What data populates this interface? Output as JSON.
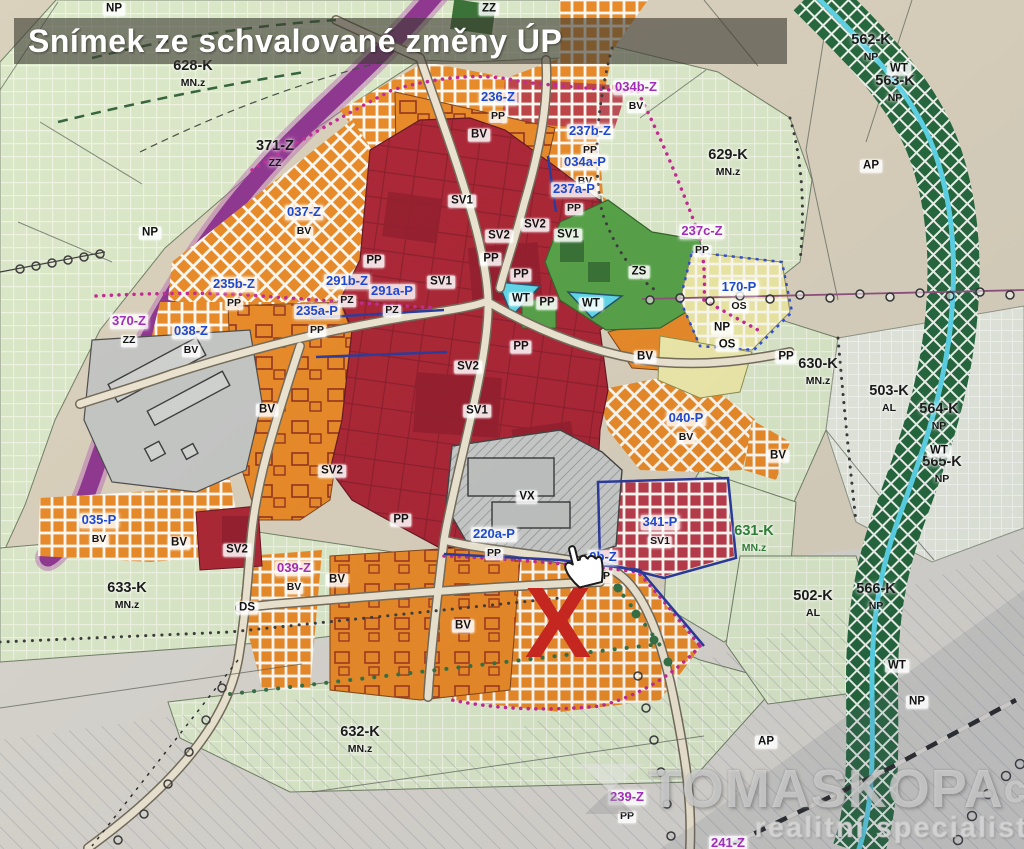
{
  "banner": {
    "text": "Snímek ze schvalované změny ÚP"
  },
  "marker": {
    "text": "X",
    "color": "#c3271f"
  },
  "icons": {
    "cursor": "hand-pointer-icon",
    "watermark_logo": "tomaskopa-logo-icon"
  },
  "watermark": {
    "brand": "TOMASKOPA",
    "suffix": "cz",
    "tagline": "realitní specialista"
  },
  "colors": {
    "banner_bg": "#3e3c32",
    "sv_red": "#a81c2c",
    "bv_orange": "#e8851e",
    "zs_green": "#4f9e3f",
    "os_yellow": "#ece79f",
    "water_cyan": "#55d2e6",
    "corridor_purple": "#8a2d8c",
    "marker_red": "#c3271f"
  },
  "map": {
    "labels": [
      {
        "t": "628-K",
        "s": "MN.z",
        "x": 193,
        "y": 74,
        "v": "k"
      },
      {
        "t": "629-K",
        "s": "MN.z",
        "x": 728,
        "y": 163,
        "v": "k"
      },
      {
        "t": "630-K",
        "s": "MN.z",
        "x": 818,
        "y": 372,
        "v": "k"
      },
      {
        "t": "503-K",
        "s": "AL",
        "x": 889,
        "y": 399,
        "v": "k"
      },
      {
        "t": "564-K",
        "s": "NP",
        "x": 939,
        "y": 417,
        "v": "k"
      },
      {
        "t": "565-K",
        "s": "NP",
        "x": 942,
        "y": 470,
        "v": "k"
      },
      {
        "t": "562-K",
        "s": "NP",
        "x": 871,
        "y": 48,
        "v": "k"
      },
      {
        "t": "563-K",
        "s": "NP",
        "x": 895,
        "y": 89,
        "v": "k"
      },
      {
        "t": "566-K",
        "s": "NP",
        "x": 876,
        "y": 597,
        "v": "k"
      },
      {
        "t": "502-K",
        "s": "AL",
        "x": 813,
        "y": 604,
        "v": "k"
      },
      {
        "t": "632-K",
        "s": "MN.z",
        "x": 360,
        "y": 740,
        "v": "k"
      },
      {
        "t": "633-K",
        "s": "MN.z",
        "x": 127,
        "y": 596,
        "v": "k"
      },
      {
        "t": "631-K",
        "s": "MN.z",
        "x": 754,
        "y": 539,
        "v": "kg"
      },
      {
        "t": "371-Z",
        "s": "ZZ",
        "x": 275,
        "y": 154,
        "v": "k"
      },
      {
        "t": "236-Z",
        "s": "PP",
        "x": 498,
        "y": 106,
        "v": "b"
      },
      {
        "t": "237b-Z",
        "s": "PP",
        "x": 590,
        "y": 140,
        "v": "b"
      },
      {
        "t": "034a-P",
        "s": "BV",
        "x": 585,
        "y": 171,
        "v": "b"
      },
      {
        "t": "237a-P",
        "s": "PP",
        "x": 574,
        "y": 198,
        "v": "b"
      },
      {
        "t": "170-P",
        "s": "OS",
        "x": 739,
        "y": 296,
        "v": "b"
      },
      {
        "t": "037-Z",
        "s": "BV",
        "x": 304,
        "y": 221,
        "v": "b"
      },
      {
        "t": "235b-Z",
        "s": "PP",
        "x": 234,
        "y": 293,
        "v": "b"
      },
      {
        "t": "291b-Z",
        "s": "PZ",
        "x": 347,
        "y": 290,
        "v": "b"
      },
      {
        "t": "291a-P",
        "s": "PZ",
        "x": 392,
        "y": 300,
        "v": "b"
      },
      {
        "t": "235a-P",
        "s": "PP",
        "x": 317,
        "y": 320,
        "v": "b"
      },
      {
        "t": "038-Z",
        "s": "BV",
        "x": 191,
        "y": 340,
        "v": "b"
      },
      {
        "t": "035-P",
        "s": "BV",
        "x": 99,
        "y": 529,
        "v": "b"
      },
      {
        "t": "040-P",
        "s": "BV",
        "x": 686,
        "y": 427,
        "v": "b"
      },
      {
        "t": "341-P",
        "s": "SV1",
        "x": 660,
        "y": 531,
        "v": "b"
      },
      {
        "t": "220a-P",
        "s": "PP",
        "x": 494,
        "y": 543,
        "v": "b"
      },
      {
        "t": "0b-Z",
        "s": "PP",
        "x": 603,
        "y": 566,
        "v": "b"
      },
      {
        "t": "034b-Z",
        "s": "BV",
        "x": 636,
        "y": 96,
        "v": "p"
      },
      {
        "t": "237c-Z",
        "s": "PP",
        "x": 702,
        "y": 240,
        "v": "p"
      },
      {
        "t": "370-Z",
        "s": "ZZ",
        "x": 129,
        "y": 330,
        "v": "p"
      },
      {
        "t": "039-Z",
        "s": "BV",
        "x": 294,
        "y": 577,
        "v": "p"
      },
      {
        "t": "239-Z",
        "s": "PP",
        "x": 627,
        "y": 806,
        "v": "p"
      },
      {
        "t": "241-Z",
        "x": 728,
        "y": 843,
        "v": "p"
      },
      {
        "t": "BV",
        "x": 479,
        "y": 135,
        "v": "pl"
      },
      {
        "t": "BV",
        "x": 267,
        "y": 410,
        "v": "pl"
      },
      {
        "t": "BV",
        "x": 645,
        "y": 357,
        "v": "pl"
      },
      {
        "t": "BV",
        "x": 778,
        "y": 456,
        "v": "pl"
      },
      {
        "t": "BV",
        "x": 179,
        "y": 543,
        "v": "pl"
      },
      {
        "t": "BV",
        "x": 463,
        "y": 626,
        "v": "pl"
      },
      {
        "t": "BV",
        "x": 337,
        "y": 580,
        "v": "pl"
      },
      {
        "t": "SV1",
        "x": 462,
        "y": 201,
        "v": "pl"
      },
      {
        "t": "SV1",
        "x": 568,
        "y": 235,
        "v": "pl"
      },
      {
        "t": "SV1",
        "x": 441,
        "y": 282,
        "v": "pl"
      },
      {
        "t": "SV1",
        "x": 477,
        "y": 411,
        "v": "pl"
      },
      {
        "t": "SV2",
        "x": 535,
        "y": 225,
        "v": "pl"
      },
      {
        "t": "SV2",
        "x": 499,
        "y": 236,
        "v": "pl"
      },
      {
        "t": "SV2",
        "x": 468,
        "y": 367,
        "v": "pl"
      },
      {
        "t": "SV2",
        "x": 332,
        "y": 471,
        "v": "pl"
      },
      {
        "t": "SV2",
        "x": 237,
        "y": 550,
        "v": "pl"
      },
      {
        "t": "PP",
        "x": 491,
        "y": 259,
        "v": "pl"
      },
      {
        "t": "PP",
        "x": 521,
        "y": 275,
        "v": "pl"
      },
      {
        "t": "PP",
        "x": 547,
        "y": 303,
        "v": "pl"
      },
      {
        "t": "PP",
        "x": 521,
        "y": 347,
        "v": "pl"
      },
      {
        "t": "PP",
        "x": 374,
        "y": 261,
        "v": "pl"
      },
      {
        "t": "PP",
        "x": 401,
        "y": 520,
        "v": "pl"
      },
      {
        "t": "PP",
        "x": 786,
        "y": 357,
        "v": "pl"
      },
      {
        "t": "WT",
        "x": 521,
        "y": 299,
        "v": "pl"
      },
      {
        "t": "WT",
        "x": 591,
        "y": 304,
        "v": "pl"
      },
      {
        "t": "WT",
        "x": 899,
        "y": 69,
        "v": "pl"
      },
      {
        "t": "WT",
        "x": 897,
        "y": 666,
        "v": "pl"
      },
      {
        "t": "WT",
        "x": 939,
        "y": 451,
        "v": "pl"
      },
      {
        "t": "NP",
        "x": 150,
        "y": 233,
        "v": "pl"
      },
      {
        "t": "NP",
        "x": 722,
        "y": 328,
        "v": "pl"
      },
      {
        "t": "NP",
        "x": 917,
        "y": 702,
        "v": "pl"
      },
      {
        "t": "NP",
        "x": 114,
        "y": 9,
        "v": "pl"
      },
      {
        "t": "OS",
        "x": 727,
        "y": 345,
        "v": "pl"
      },
      {
        "t": "ZS",
        "x": 639,
        "y": 272,
        "v": "pl"
      },
      {
        "t": "ZZ",
        "x": 489,
        "y": 9,
        "v": "pl"
      },
      {
        "t": "DS",
        "x": 247,
        "y": 608,
        "v": "pl"
      },
      {
        "t": "VX",
        "x": 527,
        "y": 497,
        "v": "pl"
      },
      {
        "t": "AP",
        "x": 871,
        "y": 166,
        "v": "pl"
      },
      {
        "t": "AP",
        "x": 766,
        "y": 742,
        "v": "pl"
      }
    ]
  }
}
